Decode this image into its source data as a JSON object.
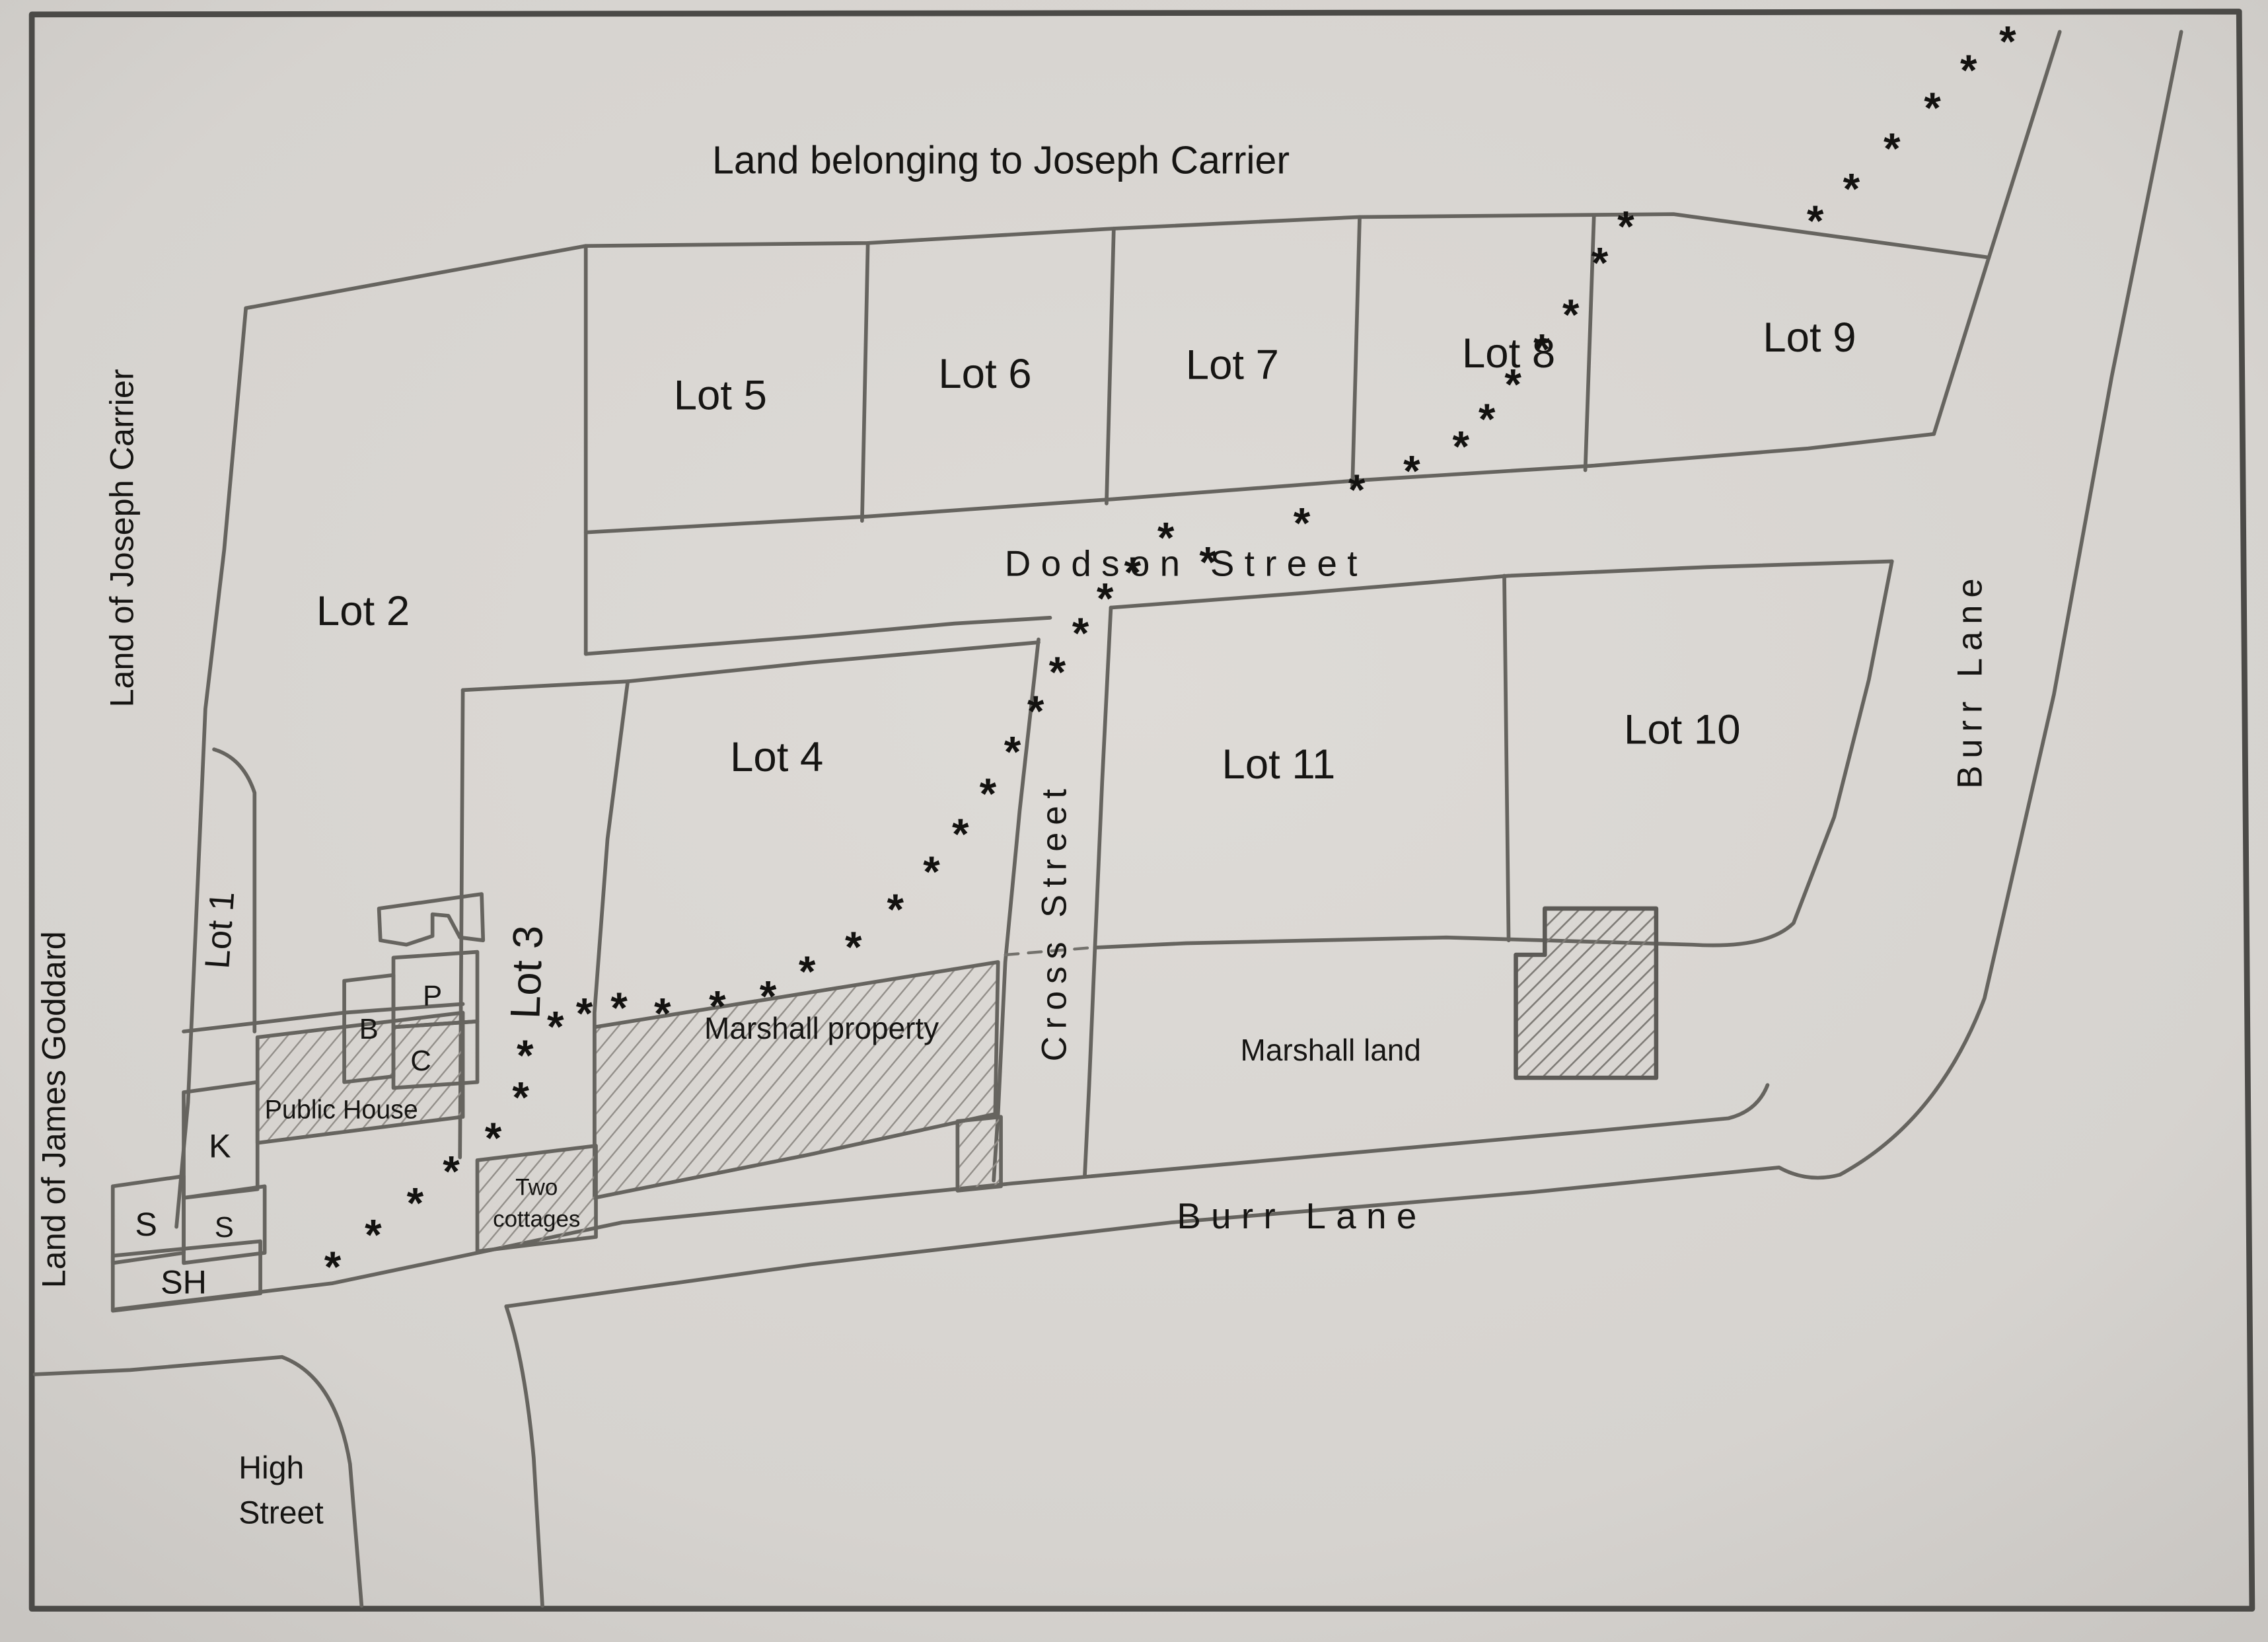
{
  "title": "Land belonging to Joseph Carrier",
  "outer_labels": {
    "west_upper": "Land of Joseph Carrier",
    "west_lower": "Land of James Goddard"
  },
  "lots": {
    "lot1": "Lot 1",
    "lot2": "Lot 2",
    "lot3": "Lot 3",
    "lot4": "Lot 4",
    "lot5": "Lot 5",
    "lot6": "Lot 6",
    "lot7": "Lot 7",
    "lot8": "Lot 8",
    "lot9": "Lot 9",
    "lot10": "Lot 10",
    "lot11": "Lot 11"
  },
  "streets": {
    "dodson": "Dodson Street",
    "cross": "Cross Street",
    "burr_lane": "Burr Lane",
    "high": "High\nStreet"
  },
  "areas": {
    "marshall_property": "Marshall property",
    "marshall_land": "Marshall land"
  },
  "buildings": {
    "public_house": "Public House",
    "two_cottages": "Two\ncottages",
    "b": "B",
    "p": "P",
    "c": "C",
    "k": "K",
    "s_inner": "S",
    "s_left": "S",
    "sh": "SH"
  },
  "trail": {
    "symbol": "*",
    "points": [
      [
        230,
        872
      ],
      [
        258,
        850
      ],
      [
        287,
        828
      ],
      [
        312,
        806
      ],
      [
        341,
        783
      ],
      [
        360,
        755
      ],
      [
        363,
        726
      ],
      [
        384,
        706
      ],
      [
        404,
        697
      ],
      [
        428,
        693
      ],
      [
        458,
        697
      ],
      [
        496,
        692
      ],
      [
        531,
        685
      ],
      [
        558,
        668
      ],
      [
        590,
        651
      ],
      [
        619,
        625
      ],
      [
        644,
        599
      ],
      [
        664,
        573
      ],
      [
        683,
        545
      ],
      [
        700,
        516
      ],
      [
        716,
        488
      ],
      [
        731,
        461
      ],
      [
        747,
        434
      ],
      [
        764,
        410
      ],
      [
        783,
        392
      ],
      [
        806,
        368
      ],
      [
        835,
        385
      ],
      [
        900,
        358
      ],
      [
        938,
        335
      ],
      [
        976,
        322
      ],
      [
        1010,
        305
      ],
      [
        1028,
        286
      ],
      [
        1046,
        262
      ],
      [
        1066,
        238
      ],
      [
        1086,
        214
      ],
      [
        1106,
        178
      ],
      [
        1124,
        153
      ],
      [
        1255,
        149
      ],
      [
        1280,
        127
      ],
      [
        1308,
        99
      ],
      [
        1336,
        71
      ],
      [
        1361,
        45
      ],
      [
        1388,
        25
      ]
    ]
  },
  "colors": {
    "paper": "#d9d6d2",
    "pencil": "#66645f",
    "frame": "#4b4a47",
    "ink": "#161513"
  }
}
